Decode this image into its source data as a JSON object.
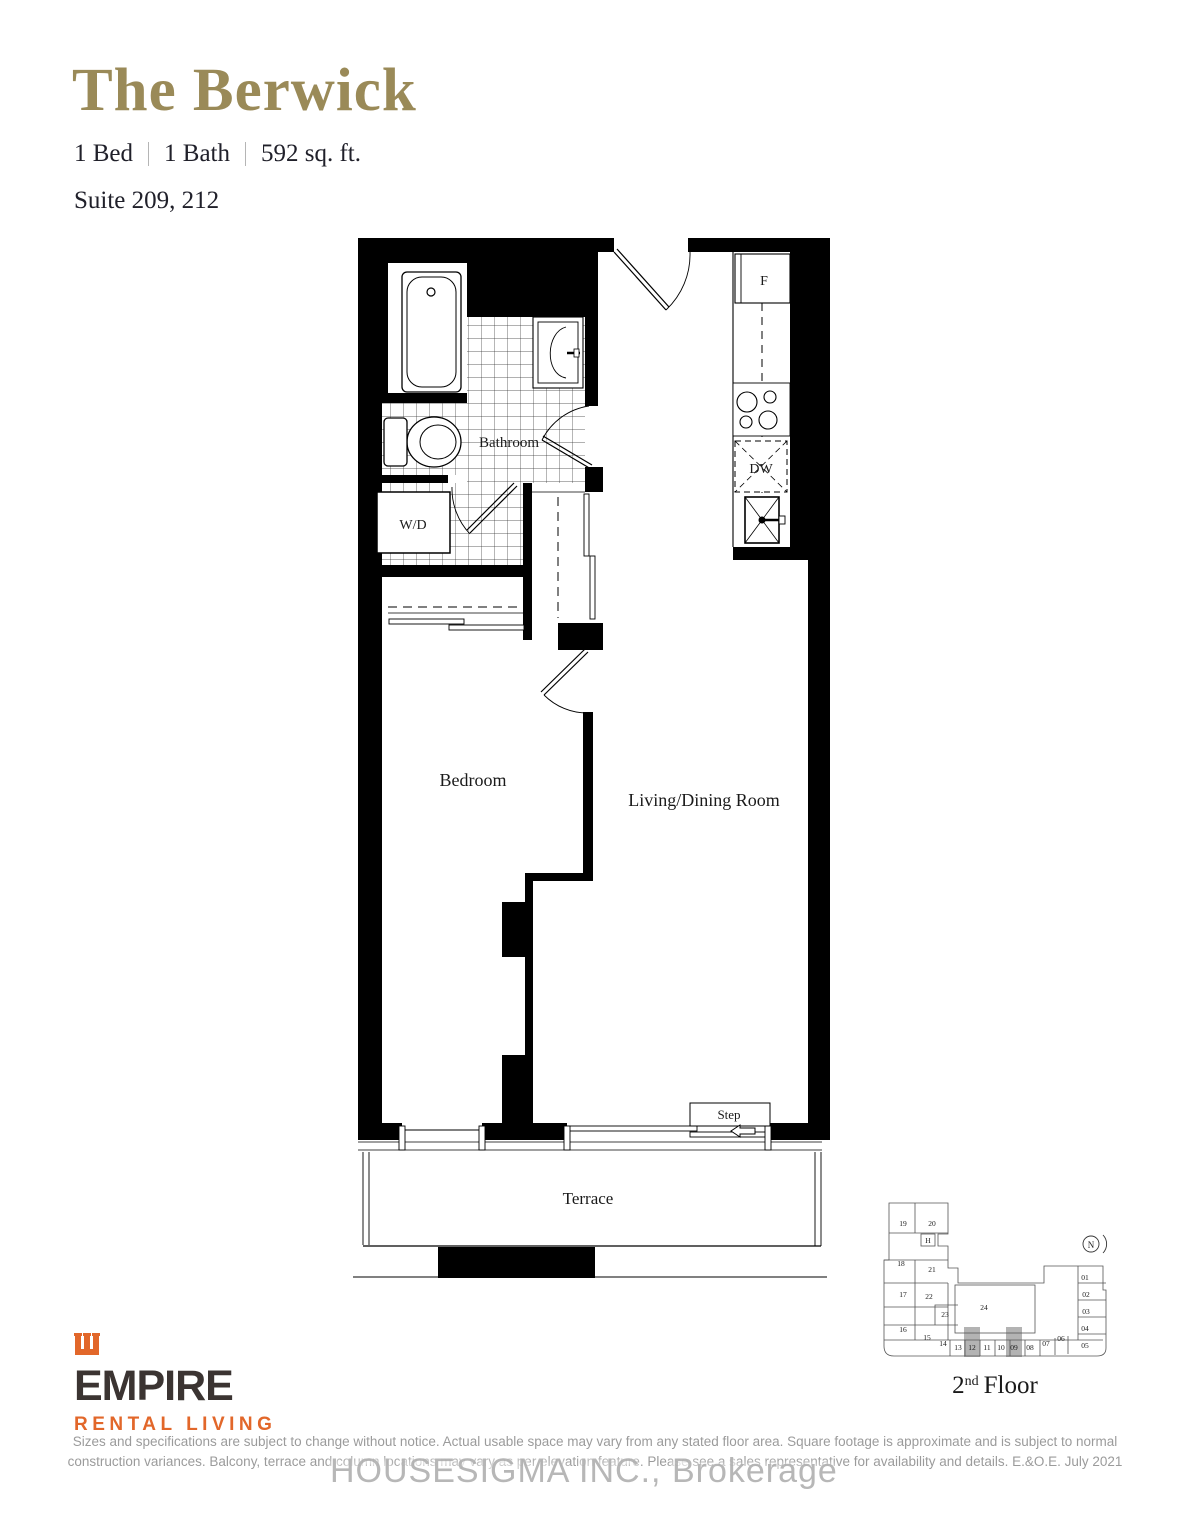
{
  "page": {
    "title": "The Berwick",
    "specs": {
      "beds": "1 Bed",
      "baths": "1 Bath",
      "area": "592 sq. ft."
    },
    "suite": "Suite 209, 212"
  },
  "plan": {
    "rooms": {
      "bathroom": "Bathroom",
      "washer_dryer": "W/D",
      "fridge": "F",
      "dishwasher": "DW",
      "bedroom": "Bedroom",
      "living": "Living/Dining Room",
      "step": "Step",
      "terrace": "Terrace"
    }
  },
  "keyplan": {
    "floor_number": "2",
    "floor_ordinal": "nd",
    "floor_word": "Floor",
    "compass": "N",
    "units": [
      "19",
      "20",
      "H",
      "18",
      "21",
      "17",
      "22",
      "23",
      "24",
      "16",
      "15",
      "14",
      "13",
      "12",
      "11",
      "10",
      "09",
      "08",
      "07",
      "06",
      "05",
      "04",
      "03",
      "02",
      "01"
    ],
    "highlighted_units": [
      "12",
      "09"
    ]
  },
  "logo": {
    "name": "EMPIRE",
    "tagline": "RENTAL LIVING"
  },
  "disclaimer": {
    "line1": "Sizes and specifications are subject to change without notice. Actual usable space may vary from any stated floor area. Square footage is approximate and is subject to normal",
    "line2": "construction variances. Balcony, terrace and column locations may vary as per elevation feature. Please see a sales representative for availability and details. E.&O.E. July 2021"
  },
  "watermark": "HOUSESIGMA INC., Brokerage",
  "colors": {
    "accent_gold": "#9a8a58",
    "logo_orange": "#e2672a",
    "logo_dark": "#3b3432",
    "disclaimer_gray": "#9b9b9b",
    "keyplan_highlight": "#b3b3b3"
  }
}
